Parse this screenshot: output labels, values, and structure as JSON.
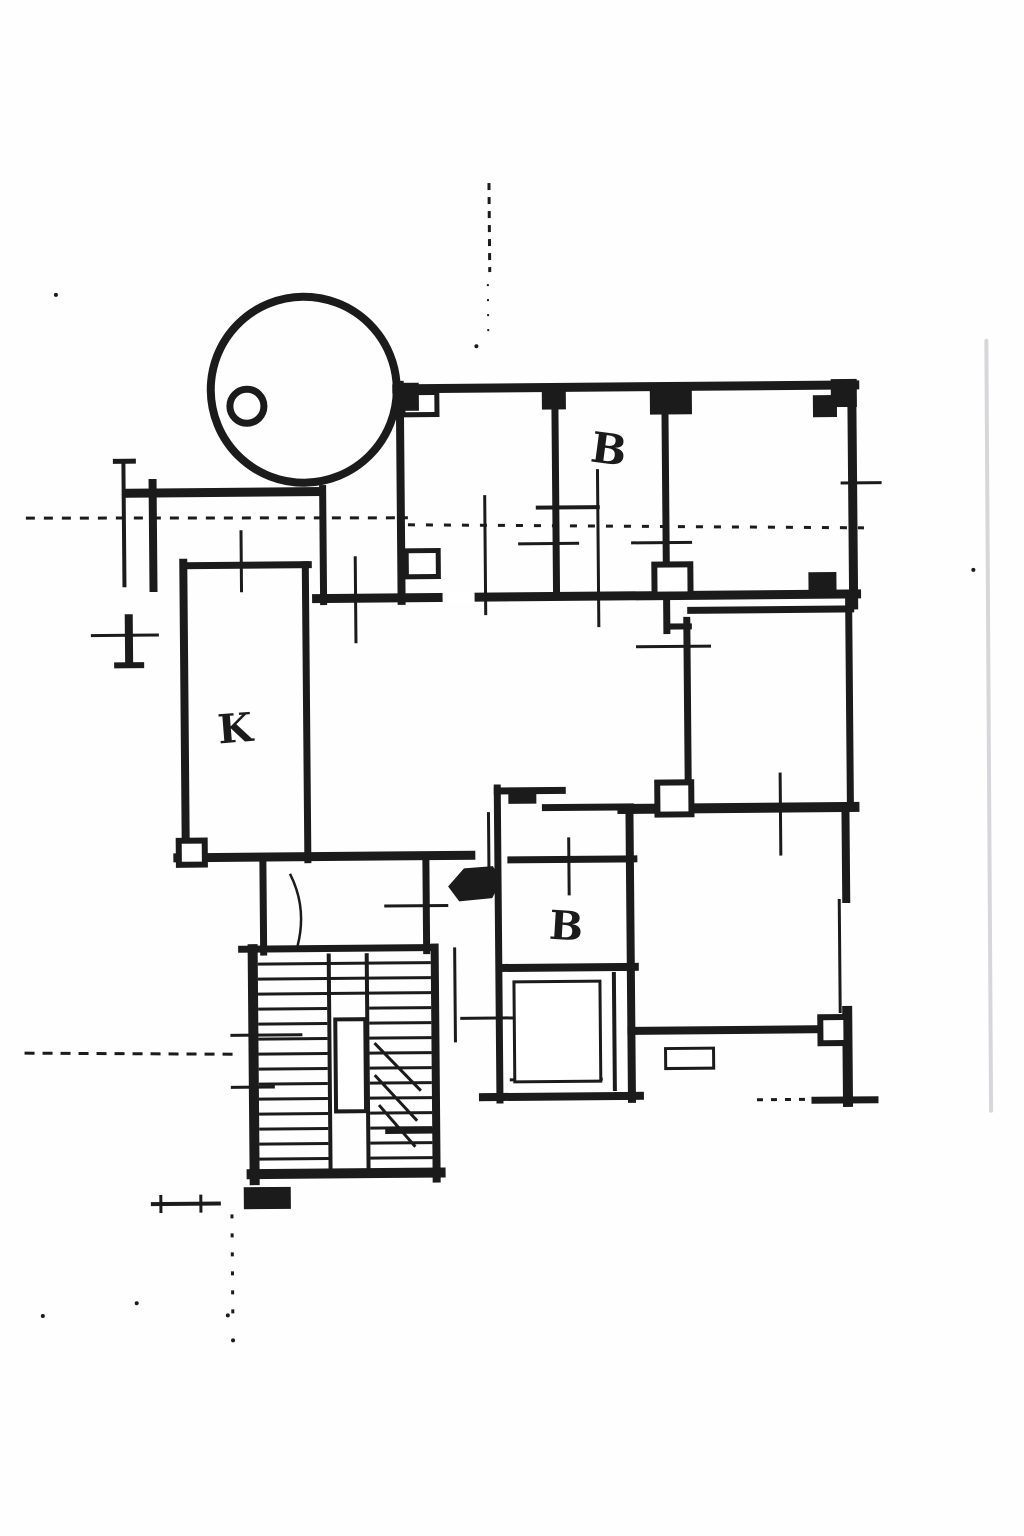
{
  "document": {
    "type": "scanned-floor-plan",
    "background": "#fefefe",
    "ink_color": "#1b1b1b",
    "artifact_color": "#d7d7db",
    "width": 1024,
    "height": 1536,
    "skew_deg": -0.5
  },
  "labels": [
    {
      "t": "B",
      "x": 592,
      "y": 462,
      "fs": 42,
      "rot": 8,
      "n": "room-label-b-upper"
    },
    {
      "t": "K",
      "x": 219,
      "y": 741,
      "fs": 40,
      "rot": -4,
      "n": "room-label-k"
    },
    {
      "t": "B",
      "x": 547,
      "y": 939,
      "fs": 40,
      "rot": 4,
      "n": "room-label-b-lower"
    }
  ],
  "walls": [
    {
      "x1": 400,
      "y1": 388,
      "x2": 858,
      "y2": 388,
      "w": 9,
      "n": "outer-wall-top"
    },
    {
      "x1": 855,
      "y1": 388,
      "x2": 855,
      "y2": 608,
      "w": 9,
      "n": "outer-wall-right-upper"
    },
    {
      "x1": 403,
      "y1": 384,
      "x2": 403,
      "y2": 600,
      "w": 8,
      "n": "wall-upper-left-room"
    },
    {
      "x1": 558,
      "y1": 391,
      "x2": 558,
      "y2": 597,
      "w": 7,
      "n": "wall-divider-1"
    },
    {
      "x1": 668,
      "y1": 391,
      "x2": 668,
      "y2": 632,
      "w": 7,
      "n": "wall-divider-2"
    },
    {
      "x1": 318,
      "y1": 597,
      "x2": 858,
      "y2": 597,
      "w": 9,
      "n": "corridor-wall"
    },
    {
      "x1": 668,
      "y1": 628,
      "x2": 690,
      "y2": 628,
      "w": 6,
      "n": "wall-jog"
    },
    {
      "x1": 692,
      "y1": 612,
      "x2": 852,
      "y2": 612,
      "w": 7,
      "n": "mid-room-wall-top"
    },
    {
      "x1": 688,
      "y1": 622,
      "x2": 688,
      "y2": 792,
      "w": 7,
      "n": "mid-room-wall-left"
    },
    {
      "x1": 850,
      "y1": 600,
      "x2": 850,
      "y2": 810,
      "w": 7,
      "n": "mid-room-wall-right"
    },
    {
      "x1": 622,
      "y1": 810,
      "x2": 854,
      "y2": 810,
      "w": 10,
      "n": "wall-horizontal-mid"
    },
    {
      "x1": 629,
      "y1": 810,
      "x2": 629,
      "y2": 1100,
      "w": 8,
      "n": "lower-room-wall-left"
    },
    {
      "x1": 845,
      "y1": 812,
      "x2": 845,
      "y2": 902,
      "w": 8,
      "n": "lower-room-wall-right"
    },
    {
      "x1": 845,
      "y1": 1014,
      "x2": 845,
      "y2": 1105,
      "w": 10,
      "n": "lower-room-wall-right"
    },
    {
      "x1": 629,
      "y1": 1032,
      "x2": 820,
      "y2": 1032,
      "w": 8,
      "n": "lower-room-wall-bottom"
    },
    {
      "x1": 812,
      "y1": 1103,
      "x2": 872,
      "y2": 1103,
      "w": 7,
      "n": "terrace-cap"
    },
    {
      "x1": 497,
      "y1": 788,
      "x2": 497,
      "y2": 1100,
      "w": 7,
      "n": "bath-wall-left"
    },
    {
      "x1": 497,
      "y1": 791,
      "x2": 562,
      "y2": 791,
      "w": 7,
      "n": "bath-wall-top"
    },
    {
      "x1": 545,
      "y1": 808,
      "x2": 630,
      "y2": 808,
      "w": 7,
      "n": "bath-wall-top-step"
    },
    {
      "x1": 510,
      "y1": 860,
      "x2": 633,
      "y2": 860,
      "w": 7,
      "n": "bath-wall-divider"
    },
    {
      "x1": 500,
      "y1": 968,
      "x2": 633,
      "y2": 968,
      "w": 8,
      "n": "bath-wall-divider"
    },
    {
      "x1": 480,
      "y1": 1097,
      "x2": 637,
      "y2": 1097,
      "w": 8,
      "n": "bath-wall-bottom"
    },
    {
      "x1": 612,
      "y1": 975,
      "x2": 612,
      "y2": 1090,
      "w": 4,
      "n": "bath-inner-wall"
    },
    {
      "x1": 185,
      "y1": 560,
      "x2": 185,
      "y2": 858,
      "w": 8,
      "n": "kitchen-wall-left"
    },
    {
      "x1": 185,
      "y1": 563,
      "x2": 310,
      "y2": 563,
      "w": 7,
      "n": "kitchen-wall-top"
    },
    {
      "x1": 307,
      "y1": 563,
      "x2": 307,
      "y2": 858,
      "w": 7,
      "n": "kitchen-wall-right"
    },
    {
      "x1": 325,
      "y1": 487,
      "x2": 325,
      "y2": 600,
      "w": 7,
      "n": "vestibule-wall"
    },
    {
      "x1": 177,
      "y1": 855,
      "x2": 470,
      "y2": 855,
      "w": 9,
      "n": "hall-wall-bottom"
    },
    {
      "x1": 262,
      "y1": 858,
      "x2": 262,
      "y2": 950,
      "w": 7,
      "n": "hall-wall"
    },
    {
      "x1": 425,
      "y1": 858,
      "x2": 425,
      "y2": 950,
      "w": 7,
      "n": "hall-wall"
    },
    {
      "x1": 240,
      "y1": 947,
      "x2": 432,
      "y2": 947,
      "w": 7,
      "n": "stair-wall-top"
    },
    {
      "x1": 251,
      "y1": 947,
      "x2": 251,
      "y2": 1178,
      "w": 10,
      "n": "stair-wall-left"
    },
    {
      "x1": 433,
      "y1": 947,
      "x2": 433,
      "y2": 1178,
      "w": 8,
      "n": "stair-wall-right"
    },
    {
      "x1": 248,
      "y1": 1172,
      "x2": 437,
      "y2": 1172,
      "w": 10,
      "n": "stair-wall-bottom"
    },
    {
      "x1": 385,
      "y1": 1130,
      "x2": 433,
      "y2": 1130,
      "w": 6,
      "n": "stair-landing-wall"
    },
    {
      "x1": 130,
      "y1": 490,
      "x2": 320,
      "y2": 490,
      "w": 9,
      "n": "balcony-wall"
    },
    {
      "x1": 155,
      "y1": 480,
      "x2": 155,
      "y2": 585,
      "w": 8,
      "n": "left-stub-wall"
    },
    {
      "x1": 130,
      "y1": 615,
      "x2": 130,
      "y2": 660,
      "w": 8,
      "n": "left-stub-wall"
    },
    {
      "x1": 118,
      "y1": 662,
      "x2": 142,
      "y2": 662,
      "w": 6,
      "n": "wall-endcap"
    },
    {
      "x1": 118,
      "y1": 458,
      "x2": 136,
      "y2": 458,
      "w": 5,
      "n": "wall-endcap"
    },
    {
      "x1": 126,
      "y1": 458,
      "x2": 126,
      "y2": 582,
      "w": 4,
      "n": "left-stub-wall-thin"
    }
  ],
  "thin": [
    {
      "x1": 243,
      "y1": 528,
      "x2": 243,
      "y2": 590
    },
    {
      "x1": 357,
      "y1": 555,
      "x2": 357,
      "y2": 642
    },
    {
      "x1": 520,
      "y1": 544,
      "x2": 581,
      "y2": 544
    },
    {
      "x1": 633,
      "y1": 544,
      "x2": 694,
      "y2": 544
    },
    {
      "x1": 538,
      "y1": 508,
      "x2": 602,
      "y2": 508,
      "w": 4
    },
    {
      "x1": 600,
      "y1": 470,
      "x2": 600,
      "y2": 628
    },
    {
      "x1": 487,
      "y1": 495,
      "x2": 487,
      "y2": 615
    },
    {
      "x1": 637,
      "y1": 648,
      "x2": 712,
      "y2": 648
    },
    {
      "x1": 780,
      "y1": 775,
      "x2": 780,
      "y2": 858
    },
    {
      "x1": 568,
      "y1": 838,
      "x2": 568,
      "y2": 896
    },
    {
      "x1": 383,
      "y1": 905,
      "x2": 447,
      "y2": 905
    },
    {
      "x1": 458,
      "y1": 1018,
      "x2": 533,
      "y2": 1018
    },
    {
      "x1": 488,
      "y1": 812,
      "x2": 488,
      "y2": 890
    },
    {
      "x1": 92,
      "y1": 632,
      "x2": 160,
      "y2": 632
    },
    {
      "x1": 228,
      "y1": 1033,
      "x2": 300,
      "y2": 1033
    },
    {
      "x1": 228,
      "y1": 1085,
      "x2": 272,
      "y2": 1085
    },
    {
      "x1": 147,
      "y1": 1201,
      "x2": 217,
      "y2": 1201,
      "w": 4
    },
    {
      "x1": 157,
      "y1": 1192,
      "x2": 157,
      "y2": 1210
    },
    {
      "x1": 197,
      "y1": 1192,
      "x2": 197,
      "y2": 1210
    },
    {
      "x1": 843,
      "y1": 486,
      "x2": 884,
      "y2": 486
    },
    {
      "x1": 838,
      "y1": 902,
      "x2": 838,
      "y2": 1016
    },
    {
      "x1": 453,
      "y1": 947,
      "x2": 453,
      "y2": 1042
    },
    {
      "x1": 507,
      "y1": 1080,
      "x2": 600,
      "y2": 1080
    },
    {
      "x1": 695,
      "y1": 1050,
      "x2": 695,
      "y2": 1070,
      "w": 2
    }
  ],
  "stairs": [
    {
      "x1": 256,
      "y1": 962,
      "x2": 429,
      "y2": 962
    },
    {
      "x1": 256,
      "y1": 977,
      "x2": 429,
      "y2": 977
    },
    {
      "x1": 256,
      "y1": 992,
      "x2": 429,
      "y2": 992
    },
    {
      "x1": 256,
      "y1": 1007,
      "x2": 325,
      "y2": 1007
    },
    {
      "x1": 256,
      "y1": 1022,
      "x2": 325,
      "y2": 1022
    },
    {
      "x1": 256,
      "y1": 1037,
      "x2": 325,
      "y2": 1037
    },
    {
      "x1": 256,
      "y1": 1052,
      "x2": 325,
      "y2": 1052
    },
    {
      "x1": 256,
      "y1": 1067,
      "x2": 325,
      "y2": 1067
    },
    {
      "x1": 256,
      "y1": 1082,
      "x2": 325,
      "y2": 1082
    },
    {
      "x1": 256,
      "y1": 1097,
      "x2": 325,
      "y2": 1097
    },
    {
      "x1": 256,
      "y1": 1112,
      "x2": 325,
      "y2": 1112
    },
    {
      "x1": 256,
      "y1": 1127,
      "x2": 325,
      "y2": 1127
    },
    {
      "x1": 256,
      "y1": 1142,
      "x2": 325,
      "y2": 1142
    },
    {
      "x1": 256,
      "y1": 1157,
      "x2": 325,
      "y2": 1157
    },
    {
      "x1": 367,
      "y1": 1007,
      "x2": 429,
      "y2": 1007
    },
    {
      "x1": 367,
      "y1": 1022,
      "x2": 429,
      "y2": 1022
    },
    {
      "x1": 367,
      "y1": 1037,
      "x2": 429,
      "y2": 1037
    },
    {
      "x1": 367,
      "y1": 1052,
      "x2": 429,
      "y2": 1052
    },
    {
      "x1": 367,
      "y1": 1067,
      "x2": 429,
      "y2": 1067
    },
    {
      "x1": 367,
      "y1": 1082,
      "x2": 429,
      "y2": 1082
    },
    {
      "x1": 367,
      "y1": 1097,
      "x2": 429,
      "y2": 1097
    },
    {
      "x1": 367,
      "y1": 1112,
      "x2": 429,
      "y2": 1112
    },
    {
      "x1": 367,
      "y1": 1127,
      "x2": 429,
      "y2": 1127
    },
    {
      "x1": 367,
      "y1": 1142,
      "x2": 429,
      "y2": 1142
    },
    {
      "x1": 367,
      "y1": 1157,
      "x2": 429,
      "y2": 1157
    },
    {
      "x1": 327,
      "y1": 952,
      "x2": 327,
      "y2": 1168,
      "w": 4
    },
    {
      "x1": 365,
      "y1": 952,
      "x2": 365,
      "y2": 1168,
      "w": 4
    },
    {
      "x1": 372,
      "y1": 1042,
      "x2": 418,
      "y2": 1090
    },
    {
      "x1": 372,
      "y1": 1074,
      "x2": 414,
      "y2": 1120
    },
    {
      "x1": 376,
      "y1": 1104,
      "x2": 412,
      "y2": 1146
    }
  ],
  "dashed": [
    {
      "x1": 494,
      "y1": 183,
      "x2": 494,
      "y2": 272,
      "da": "7 7",
      "n": "axis-dash-vertical-top"
    },
    {
      "x1": 492,
      "y1": 284,
      "x2": 492,
      "y2": 332,
      "da": "2 13",
      "w": 2,
      "n": "axis-dash-vertical-top"
    },
    {
      "x1": 28,
      "y1": 514,
      "x2": 410,
      "y2": 517,
      "da": "9 9",
      "n": "scan-dash-horizontal"
    },
    {
      "x1": 410,
      "y1": 524,
      "x2": 866,
      "y2": 531,
      "da": "7 11",
      "n": "scan-dash-horizontal"
    },
    {
      "x1": 22,
      "y1": 1049,
      "x2": 238,
      "y2": 1052,
      "da": "10 8",
      "n": "scan-dash-horizontal"
    },
    {
      "x1": 228,
      "y1": 1212,
      "x2": 228,
      "y2": 1322,
      "da": "4 15",
      "n": "axis-dash-vertical-bottom"
    },
    {
      "x1": 754,
      "y1": 1102,
      "x2": 810,
      "y2": 1102,
      "da": "6 8",
      "n": "terrace-dash"
    }
  ],
  "rects": [
    {
      "x": 663,
      "y": 1050,
      "wd": 48,
      "ht": 20,
      "sw": 3,
      "n": "sill-marker"
    },
    {
      "x": 333,
      "y": 1018,
      "wd": 30,
      "ht": 92,
      "sw": 4,
      "n": "stair-core"
    },
    {
      "x": 512,
      "y": 982,
      "wd": 86,
      "ht": 100,
      "sw": 3,
      "n": "shower-inner-room"
    },
    {
      "x": 657,
      "y": 784,
      "wd": 34,
      "ht": 32,
      "sw": 6,
      "n": "wall-pillar"
    },
    {
      "x": 818,
      "y": 1020,
      "wd": 26,
      "ht": 26,
      "sw": 6,
      "n": "wall-pillar"
    },
    {
      "x": 178,
      "y": 838,
      "wd": 26,
      "ht": 24,
      "sw": 6,
      "n": "wall-pillar"
    },
    {
      "x": 406,
      "y": 392,
      "wd": 34,
      "ht": 22,
      "sw": 5,
      "n": "wall-notch"
    },
    {
      "x": 408,
      "y": 550,
      "wd": 32,
      "ht": 26,
      "sw": 5,
      "n": "wall-notch"
    },
    {
      "x": 656,
      "y": 566,
      "wd": 36,
      "ht": 30,
      "sw": 6,
      "n": "wall-pillar"
    },
    {
      "x": 444,
      "y": 591,
      "wd": 32,
      "ht": 11,
      "fl": "#ffffff",
      "sw": 0,
      "n": "door-opening"
    },
    {
      "x": 396,
      "y": 382,
      "wd": 26,
      "ht": 28,
      "fl": "ink",
      "n": "wall-junction-block"
    },
    {
      "x": 545,
      "y": 386,
      "wd": 24,
      "ht": 24,
      "fl": "ink",
      "n": "wall-junction-block"
    },
    {
      "x": 653,
      "y": 390,
      "wd": 42,
      "ht": 26,
      "fl": "ink",
      "n": "wall-junction-block"
    },
    {
      "x": 834,
      "y": 382,
      "wd": 26,
      "ht": 28,
      "fl": "ink",
      "n": "wall-junction-block"
    },
    {
      "x": 816,
      "y": 398,
      "wd": 24,
      "ht": 22,
      "fl": "ink",
      "n": "wall-junction-block"
    },
    {
      "x": 810,
      "y": 575,
      "wd": 28,
      "ht": 24,
      "fl": "ink",
      "n": "wall-junction-block"
    },
    {
      "x": 240,
      "y": 1185,
      "wd": 47,
      "ht": 22,
      "fl": "ink",
      "n": "stair-foot-block"
    },
    {
      "x": 508,
      "y": 790,
      "wd": 28,
      "ht": 14,
      "fl": "ink",
      "n": "wall-junction-block"
    }
  ],
  "circles": [
    {
      "cx": 307,
      "cy": 388,
      "r": 93,
      "sw": 8,
      "n": "balcony-arc"
    },
    {
      "cx": 250,
      "cy": 404,
      "r": 17,
      "sw": 7,
      "fl": "#ffffff",
      "n": "balcony-column"
    }
  ],
  "paths": [
    {
      "d": "M 289 872 Q 306 906 296 944",
      "sw": 2.5,
      "n": "door-swing-arc"
    }
  ],
  "polygons": [
    {
      "pts": "447,886 463,868 492,866 500,881 491,898 458,901",
      "n": "entry-door-mark"
    }
  ],
  "specks": [
    {
      "x": 60,
      "y": 291
    },
    {
      "x": 480,
      "y": 346
    },
    {
      "x": 975,
      "y": 574
    },
    {
      "x": 132,
      "y": 1300
    },
    {
      "x": 38,
      "y": 1312
    },
    {
      "x": 223,
      "y": 1313
    },
    {
      "x": 228,
      "y": 1338
    }
  ],
  "artifact_line": {
    "x1": 990,
    "y1": 345,
    "x2": 988,
    "y2": 1115,
    "w": 4,
    "n": "scanner-artifact-line"
  }
}
